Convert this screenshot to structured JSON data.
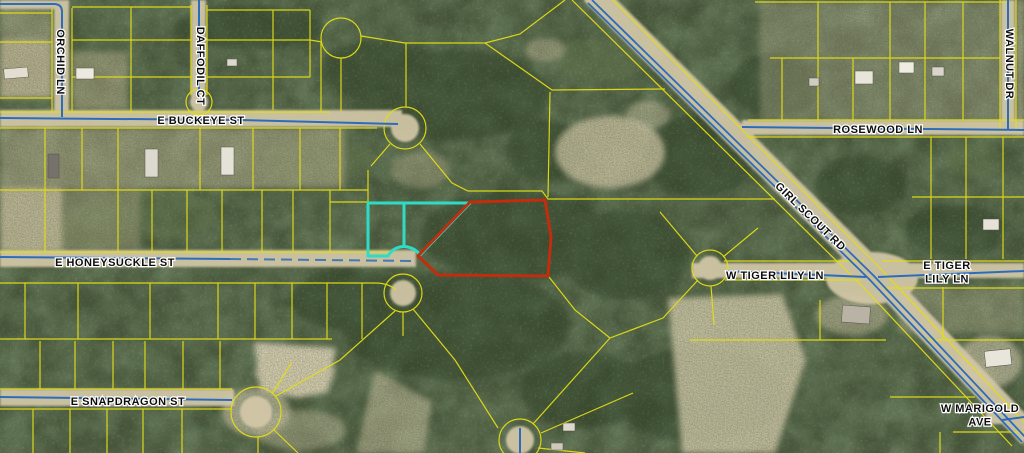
{
  "map": {
    "type": "aerial-parcel-map",
    "colors": {
      "parcel_line": "#e3dd15",
      "road_line": "#2d6cbb",
      "subject_parcel_outline": "#c22d0e",
      "adjacent_parcel_outline": "#2edcc6",
      "label_text": "#0d0d0d",
      "label_halo": "#ffffff"
    },
    "streets": [
      {
        "id": "orchid-ln",
        "label": "ORCHID LN",
        "x": 60,
        "y": 62,
        "rotation": 90
      },
      {
        "id": "daffodil-ct",
        "label": "DAFFODIL CT",
        "x": 200,
        "y": 66,
        "rotation": 90
      },
      {
        "id": "e-buckeye-st",
        "label": "E BUCKEYE ST",
        "x": 201,
        "y": 121,
        "rotation": 0
      },
      {
        "id": "rosewood-ln",
        "label": "ROSEWOOD LN",
        "x": 878,
        "y": 130,
        "rotation": 0
      },
      {
        "id": "walnut-dr",
        "label": "WALNUT DR",
        "x": 1009,
        "y": 64,
        "rotation": 90
      },
      {
        "id": "girl-scout-rd",
        "label": "GIRL SCOUT RD",
        "x": 810,
        "y": 217,
        "rotation": 44
      },
      {
        "id": "e-honeysuckle-st",
        "label": "E HONEYSUCKLE ST",
        "x": 115,
        "y": 263,
        "rotation": 0
      },
      {
        "id": "w-tiger-lily-ln",
        "label": "W TIGER LILY LN",
        "x": 775,
        "y": 276,
        "rotation": 0
      },
      {
        "id": "e-tiger-lily-ln",
        "label": "E TIGER",
        "label2": "LILY LN",
        "x": 947,
        "y": 266,
        "rotation": 0
      },
      {
        "id": "e-snapdragon-st",
        "label": "E SNAPDRAGON ST",
        "x": 128,
        "y": 402,
        "rotation": 0
      },
      {
        "id": "w-marigold-ave",
        "label": "W MARIGOLD",
        "label2": "AVE",
        "x": 980,
        "y": 409,
        "rotation": 0
      }
    ],
    "highlighted_parcels": [
      {
        "id": "subject-parcel",
        "outline_color": "#c22d0e",
        "shape": "irregular pentagon east of cul-de-sac"
      },
      {
        "id": "adjacent-parcel",
        "outline_color": "#2edcc6",
        "shape": "two-lot rectangle west of subject parcel"
      }
    ]
  }
}
